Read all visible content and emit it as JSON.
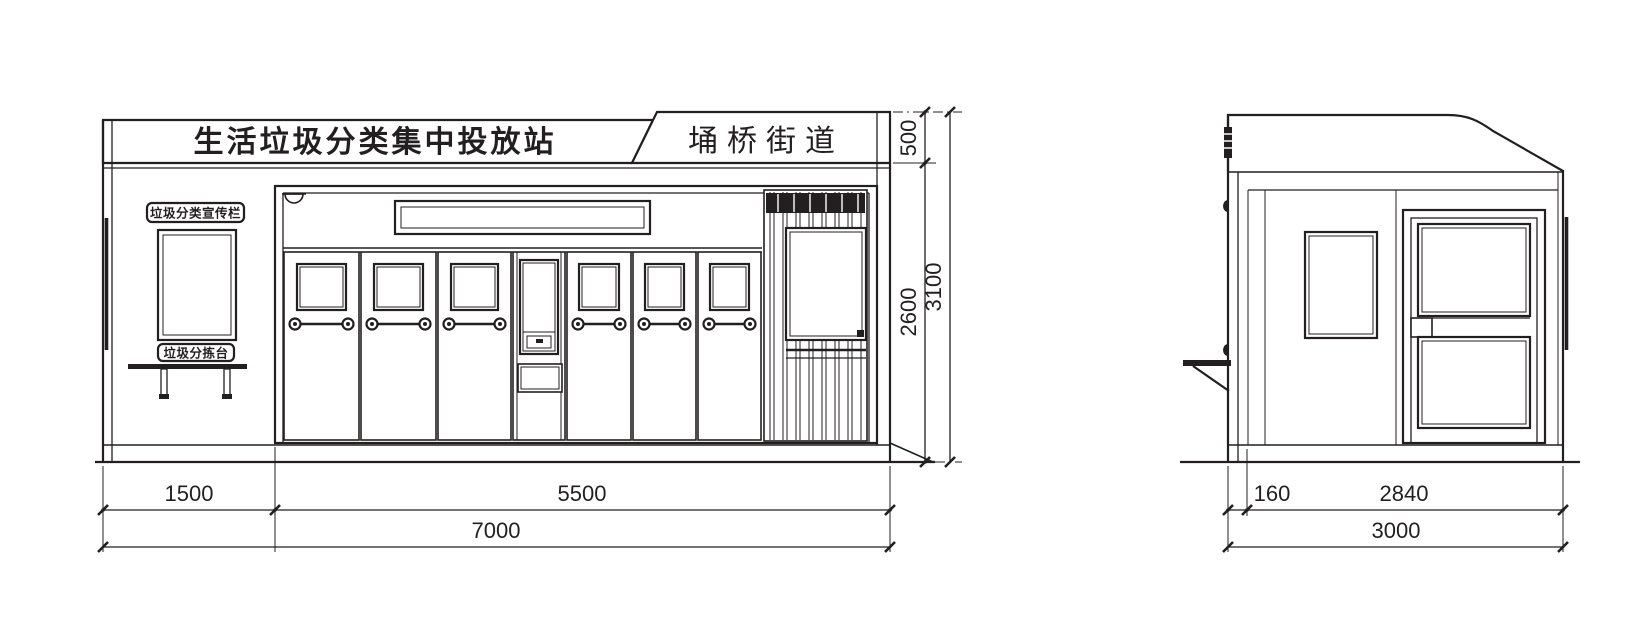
{
  "front_view": {
    "main_sign": "生活垃圾分类集中投放站",
    "district_sign": "埇桥街道",
    "publicity_board_label": "垃圾分类宣传栏",
    "sorting_table_label": "垃圾分拣台",
    "dims": {
      "band_height": "500",
      "body_height": "2600",
      "total_height": "3100",
      "left_width": "1500",
      "bin_width": "5500",
      "total_width": "7000"
    }
  },
  "side_view": {
    "dims": {
      "front_offset": "160",
      "body_depth": "2840",
      "total_depth": "3000"
    }
  },
  "colors": {
    "line": "#231f20",
    "background": "#ffffff"
  }
}
